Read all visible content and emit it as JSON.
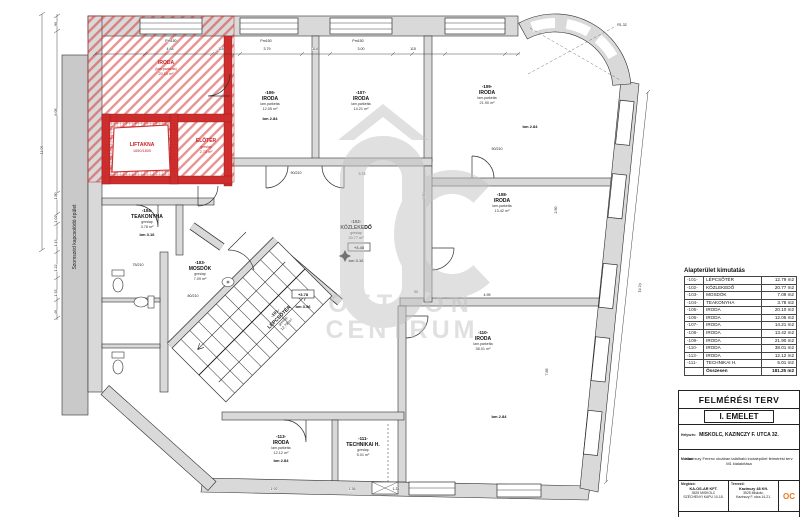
{
  "plan": {
    "neighbor_label": "Szomszéd kapcsolódó épület",
    "watermark": {
      "line1": "OTTHON",
      "line2": "CENTRUM"
    },
    "rooms": [
      {
        "num": "",
        "name": "IRODA",
        "mat": "(lam.parketta)",
        "area": "20.10 m²",
        "bm": ""
      },
      {
        "num": "",
        "name": "LIFTAKNA",
        "mat": "1650/1800",
        "area": "",
        "bm": ""
      },
      {
        "num": "",
        "name": "ELŐTÉR",
        "mat": "greslap",
        "area": "2.73 m²",
        "bm": ""
      },
      {
        "num": "-104-",
        "name": "TEAKONYHA",
        "mat": "greslap",
        "area": "3.78 m²",
        "bm": "bm 3.16"
      },
      {
        "num": "-103-",
        "name": "MOSDÓK",
        "mat": "greslap",
        "area": "7.09 m²",
        "bm": ""
      },
      {
        "num": "-102-",
        "name": "KÖZLEKEDŐ",
        "mat": "greslap",
        "area": "20.77 m²",
        "bm": "bm 3.16"
      },
      {
        "num": "-101-",
        "name": "LÉPCSŐTÉR",
        "mat": "greslap",
        "area": "12.79 m²",
        "bm": ""
      },
      {
        "num": "-106-",
        "name": "IRODA",
        "mat": "lam.parketta",
        "area": "12.05 m²",
        "bm": "bm 2.84"
      },
      {
        "num": "-107-",
        "name": "IRODA",
        "mat": "lam.parketta",
        "area": "14.21 m²",
        "bm": ""
      },
      {
        "num": "-109-",
        "name": "IRODA",
        "mat": "lam.parketta",
        "area": "21.90 m²",
        "bm": "bm 2.84"
      },
      {
        "num": "-108-",
        "name": "IRODA",
        "mat": "lam.parketta",
        "area": "13.42 m²",
        "bm": ""
      },
      {
        "num": "-110-",
        "name": "IRODA",
        "mat": "lam.parketta",
        "area": "38.01 m²",
        "bm": "bm 2.84"
      },
      {
        "num": "-113-",
        "name": "IRODA",
        "mat": "lam.parketta",
        "area": "12.12 m²",
        "bm": "bm 2.84"
      },
      {
        "num": "-111-",
        "name": "TECHNIKAI H.",
        "mat": "greslap",
        "area": "5.01 m²",
        "bm": ""
      }
    ],
    "levels": [
      {
        "value": "+3.48",
        "bm": ""
      },
      {
        "value": "+3.78",
        "bm": "bm 3.56"
      }
    ],
    "dimensions": [
      {
        "t": "90",
        "x": 57,
        "y": 24,
        "r": -90
      },
      {
        "t": "6.08",
        "x": 57,
        "y": 112,
        "r": -90
      },
      {
        "t": "11.06",
        "x": 43,
        "y": 150,
        "r": -90
      },
      {
        "t": "1.80",
        "x": 57,
        "y": 196,
        "r": -90
      },
      {
        "t": "1.02",
        "x": 57,
        "y": 219,
        "r": -90
      },
      {
        "t": "1.43",
        "x": 57,
        "y": 243,
        "r": -90
      },
      {
        "t": "1.22",
        "x": 57,
        "y": 268,
        "r": -90
      },
      {
        "t": "1.33",
        "x": 57,
        "y": 293,
        "r": -90
      },
      {
        "t": "40",
        "x": 57,
        "y": 312,
        "r": -90
      },
      {
        "t": "4.88",
        "x": 170,
        "y": 50,
        "r": 0
      },
      {
        "t": "115",
        "x": 221,
        "y": 50,
        "r": 0
      },
      {
        "t": "3.79",
        "x": 267,
        "y": 50,
        "r": 0
      },
      {
        "t": "114",
        "x": 315,
        "y": 50,
        "r": 0
      },
      {
        "t": "3.00",
        "x": 361,
        "y": 50,
        "r": 0
      },
      {
        "t": "115",
        "x": 413,
        "y": 50,
        "r": 0
      },
      {
        "t": "Pm150",
        "x": 171,
        "y": 42,
        "r": 0
      },
      {
        "t": "Pm150",
        "x": 266,
        "y": 42,
        "r": 0
      },
      {
        "t": "Pm150",
        "x": 358,
        "y": 42,
        "r": 0
      },
      {
        "t": "R1.32",
        "x": 622,
        "y": 26,
        "r": 0
      },
      {
        "t": "14.70",
        "x": 641,
        "y": 288,
        "r": -84
      },
      {
        "t": "2.80",
        "x": 425,
        "y": 196,
        "r": -90
      },
      {
        "t": "3.72",
        "x": 362,
        "y": 175,
        "r": 0
      },
      {
        "t": "2.50",
        "x": 557,
        "y": 210,
        "r": -90
      },
      {
        "t": "7.85",
        "x": 548,
        "y": 372,
        "r": -90
      },
      {
        "t": "4.95",
        "x": 487,
        "y": 296,
        "r": 0
      },
      {
        "t": "90/210",
        "x": 497,
        "y": 150,
        "r": 0
      },
      {
        "t": "75/210",
        "x": 138,
        "y": 266,
        "r": 0
      },
      {
        "t": "80/210",
        "x": 193,
        "y": 297,
        "r": 0
      },
      {
        "t": "90/210",
        "x": 296,
        "y": 174,
        "r": 0
      },
      {
        "t": "1.92",
        "x": 274,
        "y": 490,
        "r": 0
      },
      {
        "t": "1.36",
        "x": 352,
        "y": 490,
        "r": 0
      },
      {
        "t": "1.34",
        "x": 396,
        "y": 490,
        "r": 0
      },
      {
        "t": "90",
        "x": 416,
        "y": 293,
        "r": 0
      }
    ]
  },
  "area_table": {
    "title": "Alapterület kimutatás",
    "rows": [
      {
        "num": "-101-",
        "name": "LÉPCSŐTÉR",
        "area": "12.79 m2"
      },
      {
        "num": "-102-",
        "name": "KÖZLEKEDŐ",
        "area": "20.77 m2"
      },
      {
        "num": "-103-",
        "name": "MOSDÓK",
        "area": "7.09 m2"
      },
      {
        "num": "-104-",
        "name": "TEAKONYHA",
        "area": "3.78 m2"
      },
      {
        "num": "-105-",
        "name": "IRODA",
        "area": "20.10 m2"
      },
      {
        "num": "-106-",
        "name": "IRODA",
        "area": "12.05 m2"
      },
      {
        "num": "-107-",
        "name": "IRODA",
        "area": "14.21 m2"
      },
      {
        "num": "-108-",
        "name": "IRODA",
        "area": "13.42 m2"
      },
      {
        "num": "-109-",
        "name": "IRODA",
        "area": "21.90 m2"
      },
      {
        "num": "-110-",
        "name": "IRODA",
        "area": "38.01 m2"
      },
      {
        "num": "-113-",
        "name": "IRODA",
        "area": "12.12 m2"
      },
      {
        "num": "-111-",
        "name": "TECHNIKAI H.",
        "area": "5.01 m2"
      },
      {
        "num": "",
        "name": "Összesen",
        "area": "181.25 m2"
      }
    ]
  },
  "titleblock": {
    "doc_type": "FELMÉRÉSI TERV",
    "floor": "I. EMELET",
    "site_label": "Helyszín:",
    "site": "MISKOLC, KAZINCZY F. UTCA 32.",
    "work_label": "Munka:",
    "work": "Kazinczy Ferenc utcában található irodaépület felmérési terv M1 kialakítása",
    "client_label": "Megbízó:",
    "client1": "KA-OS-AR KFT.",
    "client2": "3525 MISKOLC",
    "client3": "SZÉCHENYI KAPU 10-18.",
    "office_label": "Tervező:",
    "office1": "Kazinczy 48 Kft.",
    "office2": "3525 Miskolc,",
    "office3": "Kazinczy F. utca 14-21.",
    "stamp": "OC",
    "resp_label": "Felelős tervező:",
    "resp_name": "Erdei Norbert",
    "resp_cred": "okl. építészmérnök É 10-0434"
  }
}
